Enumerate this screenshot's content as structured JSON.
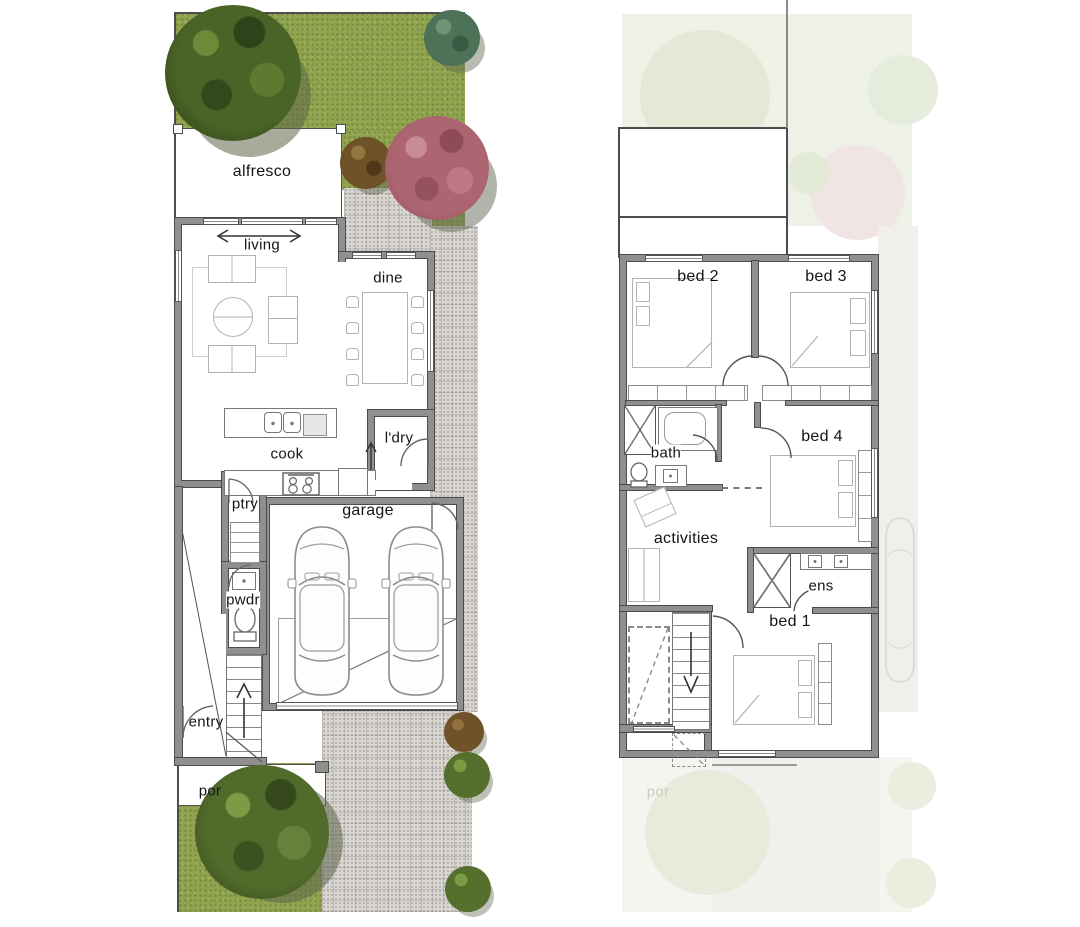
{
  "plan": {
    "type": "two-storey townhouse floor plan",
    "ground_floor": {
      "rooms": {
        "alfresco": "alfresco",
        "living": "living",
        "dine": "dine",
        "cook": "cook",
        "pantry": "ptry",
        "laundry": "l'dry",
        "garage": "garage",
        "powder": "pwdr",
        "entry": "entry",
        "porch": "por"
      }
    },
    "first_floor": {
      "rooms": {
        "bed2": "bed 2",
        "bed3": "bed 3",
        "bath": "bath",
        "bed4": "bed 4",
        "activities": "activities",
        "ensuite": "ens",
        "bed1": "bed 1"
      },
      "ghost_porch": "por"
    },
    "colors": {
      "grass": "#8ea24c",
      "paving": "#d9d5d1",
      "wall": "#8f8f8f",
      "wall_outline": "#4b4b4b",
      "tree_green_dark": "#41581f",
      "tree_green_light": "#6d8a39",
      "tree_teal": "#4e7257",
      "tree_brown": "#6f5227",
      "tree_pink": "#ae6572",
      "ghost_green": "#e9eedd"
    }
  }
}
